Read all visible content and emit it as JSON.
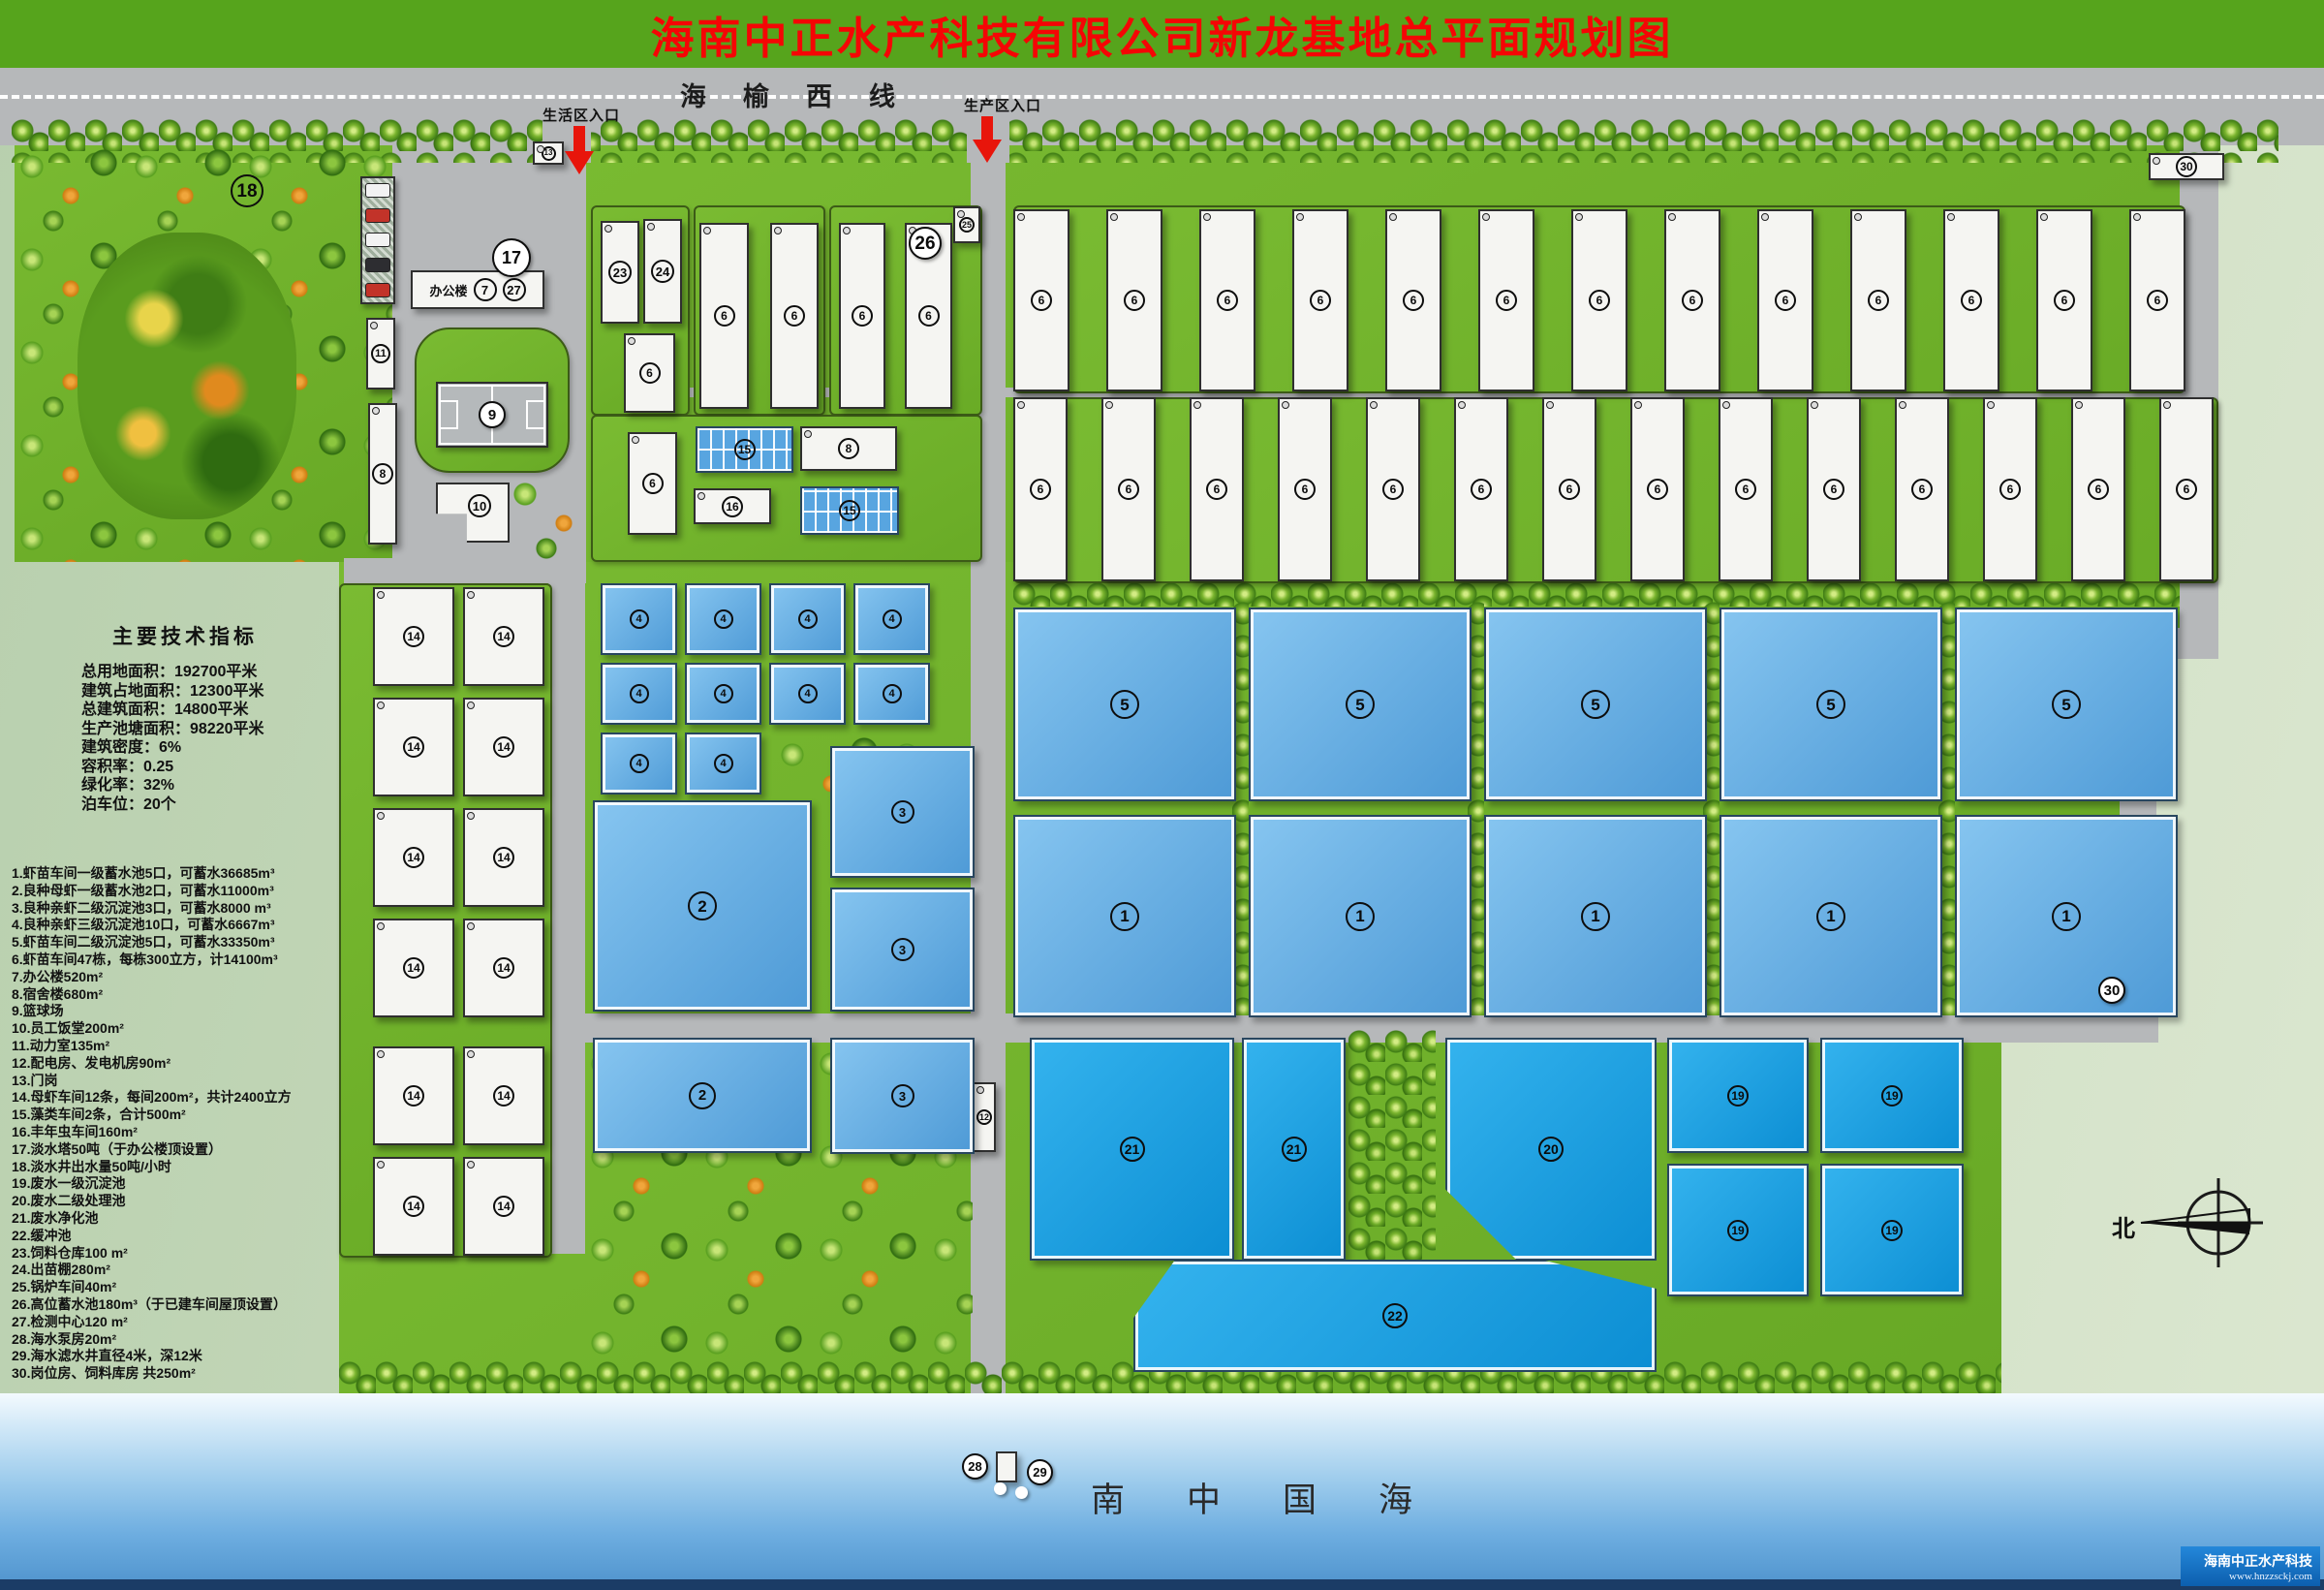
{
  "banner": {
    "title": "海南中正水产科技有限公司新龙基地总平面规划图"
  },
  "road": {
    "name": "海榆西线",
    "living_entrance": "生活区入口",
    "production_entrance": "生产区入口"
  },
  "indicators": {
    "title": "主要技术指标",
    "lines": [
      "总用地面积：192700平米",
      "建筑占地面积：12300平米",
      "总建筑面积：14800平米",
      "生产池塘面积：98220平米",
      "建筑密度：6%",
      "容积率：0.25",
      "绿化率：32%",
      "泊车位：20个"
    ]
  },
  "legend": {
    "items": [
      "1.虾苗车间一级蓄水池5口，可蓄水36685m³",
      "2.良种母虾一级蓄水池2口，可蓄水11000m³",
      "3.良种亲虾二级沉淀池3口，可蓄水8000 m³",
      "4.良种亲虾三级沉淀池10口，可蓄水6667m³",
      "5.虾苗车间二级沉淀池5口，可蓄水33350m³",
      "6.虾苗车间47栋，每栋300立方，计14100m³",
      "7.办公楼520m²",
      "8.宿舍楼680m²",
      "9.篮球场",
      "10.员工饭堂200m²",
      "11.动力室135m²",
      "12.配电房、发电机房90m²",
      "13.门岗",
      "14.母虾车间12条，每间200m²，共计2400立方",
      "15.藻类车间2条，合计500m²",
      "16.丰年虫车间160m²",
      "17.淡水塔50吨（于办公楼顶设置）",
      "18.淡水井出水量50吨/小时",
      "19.废水一级沉淀池",
      "20.废水二级处理池",
      "21.废水净化池",
      "22.缓冲池",
      "23.饲料仓库100 m²",
      "24.出苗棚280m²",
      "25.锅炉车间40m²",
      "26.高位蓄水池180m³（于已建车间屋顶设置）",
      "27.检测中心120 m²",
      "28.海水泵房20m²",
      "29.海水滤水井直径4米，深12米",
      "30.岗位房、饲料库房 共250m²"
    ]
  },
  "map": {
    "office_label": "办公楼",
    "circle_labels": {
      "p1": "1",
      "p2": "2",
      "p3": "3",
      "p4": "4",
      "p5": "5",
      "workshop": "6",
      "office": "7",
      "dorm": "8",
      "court": "9",
      "canteen": "10",
      "power": "11",
      "elec": "12",
      "gate": "13",
      "mother": "14",
      "algae": "15",
      "brine": "16",
      "tower": "17",
      "garden": "18",
      "sed1": "19",
      "sed2": "20",
      "purify": "21",
      "buffer": "22",
      "feed": "23",
      "outseed": "24",
      "boiler": "25",
      "highpond": "26",
      "lab": "27",
      "pump": "28",
      "well": "29",
      "guard": "30"
    }
  },
  "sea": {
    "label": "南中国海"
  },
  "compass": {
    "north": "北"
  },
  "footer": {
    "company": "海南中正水产科技",
    "website": "www.hnzzsckj.com"
  },
  "colors": {
    "banner_green": "#56a41c",
    "title_red": "#f50505",
    "road_gray": "#b6b8ba",
    "grass_green": "#79ba31",
    "pale_green": "#c9dabd",
    "pond_blue": "#4e9ad6",
    "pond_vivid": "#0c8ed3",
    "sea_blue": "#6dade0",
    "footer_blue": "#0c5fae",
    "arrow_red": "#e8150b"
  }
}
